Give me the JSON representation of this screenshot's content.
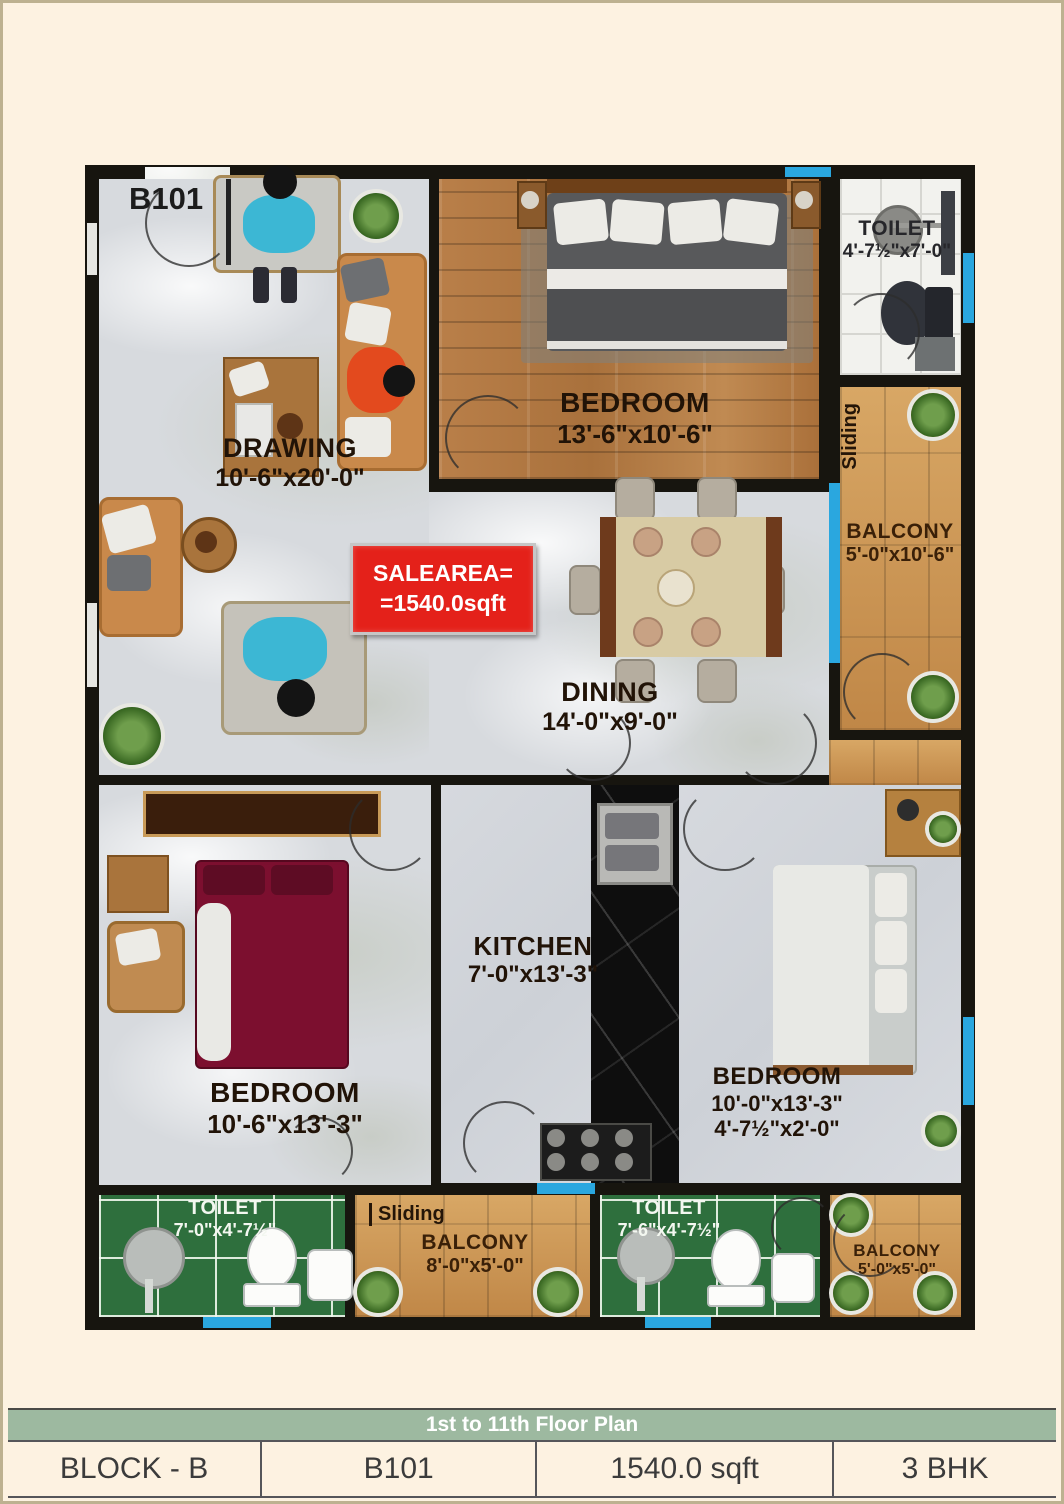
{
  "plan": {
    "unit_label": "B101",
    "sale_box": {
      "line1": "SALEAREA=",
      "line2": "=1540.0sqft"
    },
    "labels": {
      "sliding_right": "Sliding",
      "sliding_bottom": "Sliding"
    },
    "rooms": {
      "drawing": {
        "name": "DRAWING",
        "dims": "10'-6\"x20'-0\""
      },
      "bedroom_top": {
        "name": "BEDROOM",
        "dims": "13'-6\"x10'-6\""
      },
      "toilet_top": {
        "name": "TOILET",
        "dims": "4'-7½\"x7'-0\""
      },
      "balcony_right": {
        "name": "BALCONY",
        "dims": "5'-0\"x10'-6\""
      },
      "dining": {
        "name": "DINING",
        "dims": "14'-0\"x9'-0\""
      },
      "kitchen": {
        "name": "KITCHEN",
        "dims": "7'-0\"x13'-3\""
      },
      "bedroom_left": {
        "name": "BEDROOM",
        "dims": "10'-6\"x13'-3\""
      },
      "bedroom_right": {
        "name": "BEDROOM",
        "dims": "10'-0\"x13'-3\"",
        "dims2": "4'-7½\"x2'-0\""
      },
      "toilet_bottom_left": {
        "name": "TOILET",
        "dims": "7'-0\"x4'-7½\""
      },
      "balcony_bottom": {
        "name": "BALCONY",
        "dims": "8'-0\"x5'-0\""
      },
      "toilet_bottom_mid": {
        "name": "TOILET",
        "dims": "7'-6\"x4'-7½\""
      },
      "balcony_bottom_right": {
        "name": "BALCONY",
        "dims": "5'-0\"x5'-0\""
      }
    }
  },
  "footer": {
    "bar": "1st to 11th Floor Plan",
    "cells": [
      "BLOCK - B",
      "B101",
      "1540.0 sqft",
      "3 BHK"
    ]
  },
  "colors": {
    "background": "#fdf2e1",
    "wall": "#17150f",
    "window_blue": "#2aa7df",
    "sale_box_red": "#e4211a",
    "footer_bar_green": "#9db9a0",
    "toilet_tile_green": "#2e6f3d"
  }
}
